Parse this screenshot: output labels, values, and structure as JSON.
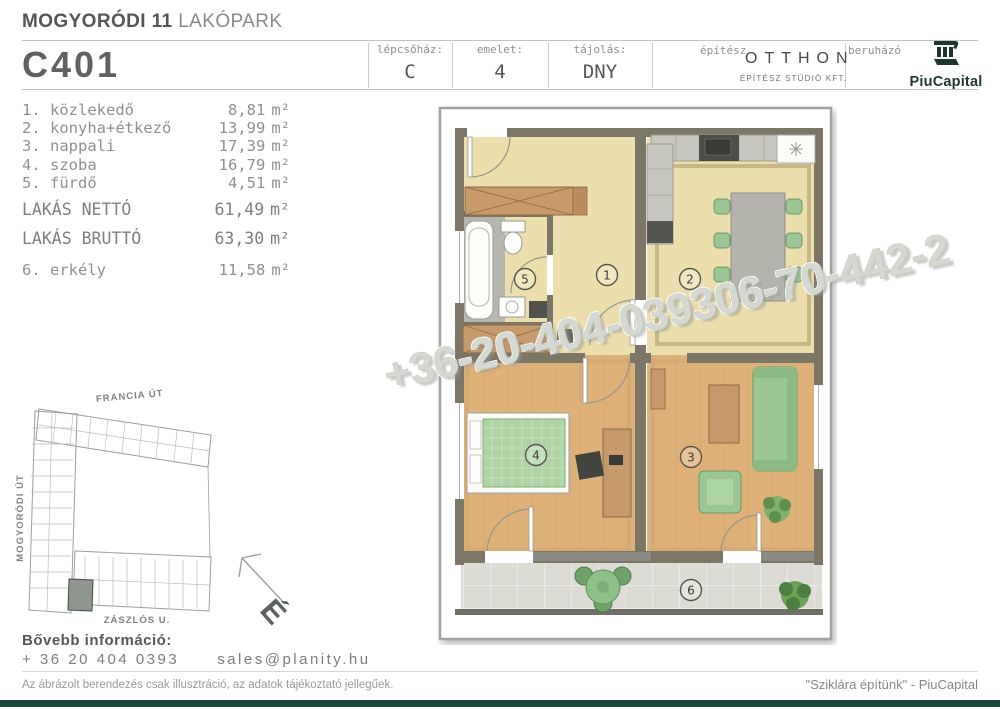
{
  "header": {
    "project_bold": "MOGYORÓDI 11",
    "project_light": "LAKÓPARK",
    "unit_code": "C401",
    "cells": [
      {
        "label": "lépcsőház:",
        "value": "C"
      },
      {
        "label": "emelet:",
        "value": "4"
      },
      {
        "label": "tájolás:",
        "value": "DNY"
      }
    ],
    "architect_label": "építész",
    "architect_name": "OTTHON",
    "architect_sub": "ÉPÍTÉSZ STÚDIÓ KFT.",
    "developer_label": "beruházó",
    "developer_name": "PiuCapital"
  },
  "rooms": {
    "unit": "m²",
    "rows": [
      {
        "name": "1. közlekedő",
        "area": "8,81"
      },
      {
        "name": "2. konyha+étkező",
        "area": "13,99"
      },
      {
        "name": "3. nappali",
        "area": "17,39"
      },
      {
        "name": "4. szoba",
        "area": "16,79"
      },
      {
        "name": "5. fürdő",
        "area": "4,51"
      },
      {
        "name": "LAKÁS NETTÓ",
        "area": "61,49"
      },
      {
        "name": "LAKÁS BRUTTÓ",
        "area": "63,30"
      },
      {
        "name": "6. erkély",
        "area": "11,58"
      }
    ]
  },
  "site_plan": {
    "street_top": "FRANCIA ÚT",
    "street_left": "MOGYORÓDI ÚT",
    "street_bottom": "ZÁSZLÓS U.",
    "compass_letter": "É"
  },
  "floor_plan": {
    "room_numbers": [
      "1",
      "2",
      "3",
      "4",
      "5",
      "6"
    ]
  },
  "watermark": {
    "text": "+36-20-404-039306-70-442-2"
  },
  "contact": {
    "heading": "Bővebb információ:",
    "phone": "+ 36 20 404 0393",
    "email": "sales@planity.hu"
  },
  "footer": {
    "disclaimer": "Az ábrázolt berendezés csak illusztráció, az adatok tájékoztató jellegűek.",
    "slogan": "\"Sziklára építünk\" - PiuCapital"
  },
  "colors": {
    "brand_green": "#1b473c",
    "floor_pale": "#ecdfad",
    "floor_wood": "#dfb17a",
    "furniture_green": "#9cc795",
    "wall_olive": "#7c7666"
  }
}
